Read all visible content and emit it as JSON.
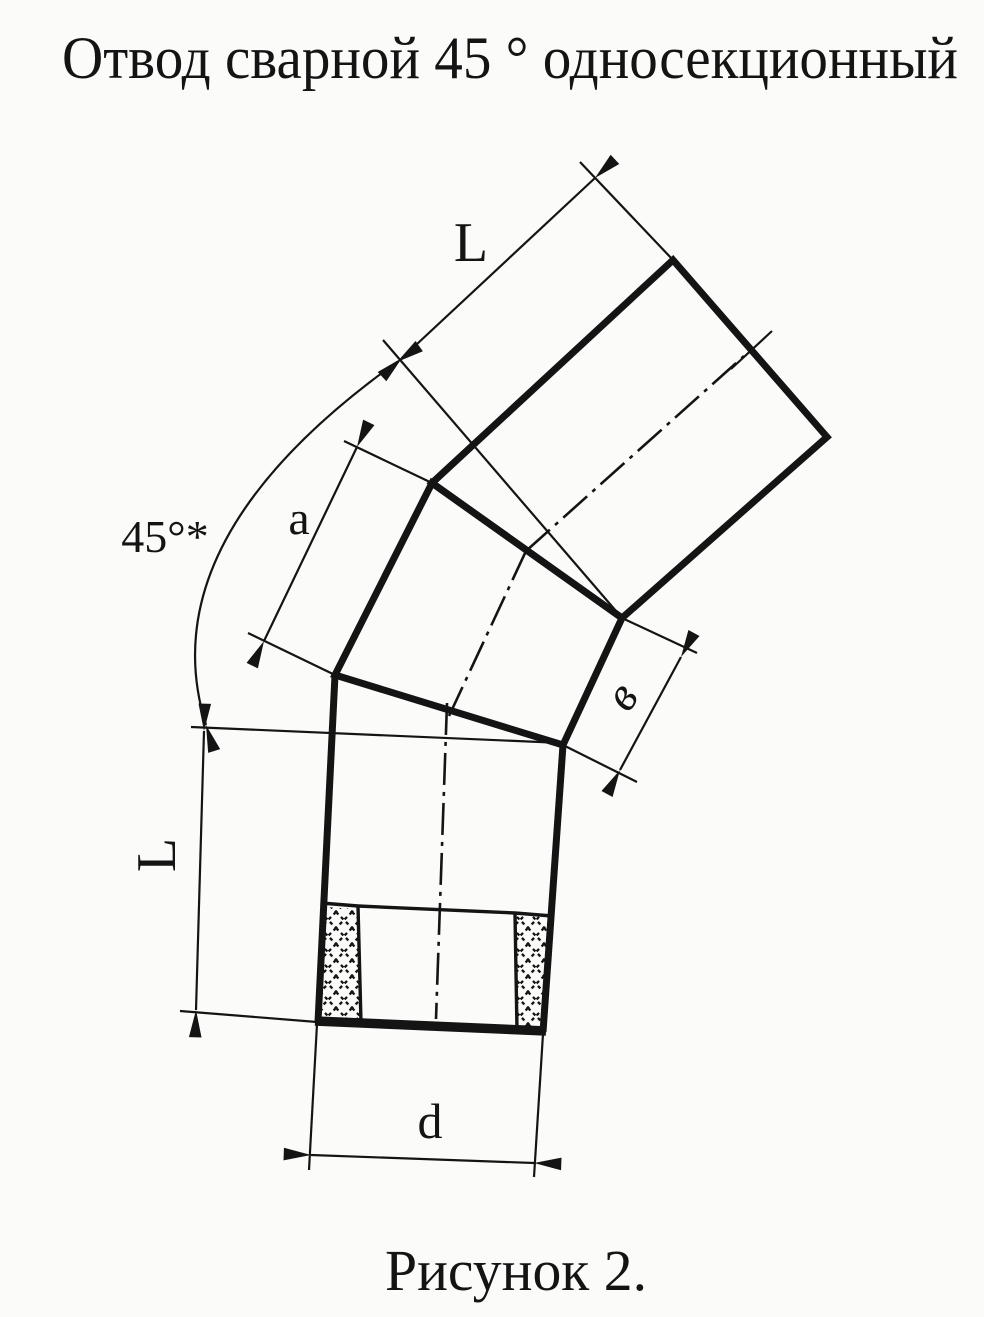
{
  "colors": {
    "ink": "#141414",
    "paper": "#fbfbf9"
  },
  "title": "Отвод сварной 45 ° односекционный",
  "caption": "Рисунок 2.",
  "labels": {
    "length_upper": "L",
    "section_outer": "a",
    "bend_angle": "45°*",
    "section_inner": "в",
    "length_lower": "L",
    "diameter": "d"
  }
}
